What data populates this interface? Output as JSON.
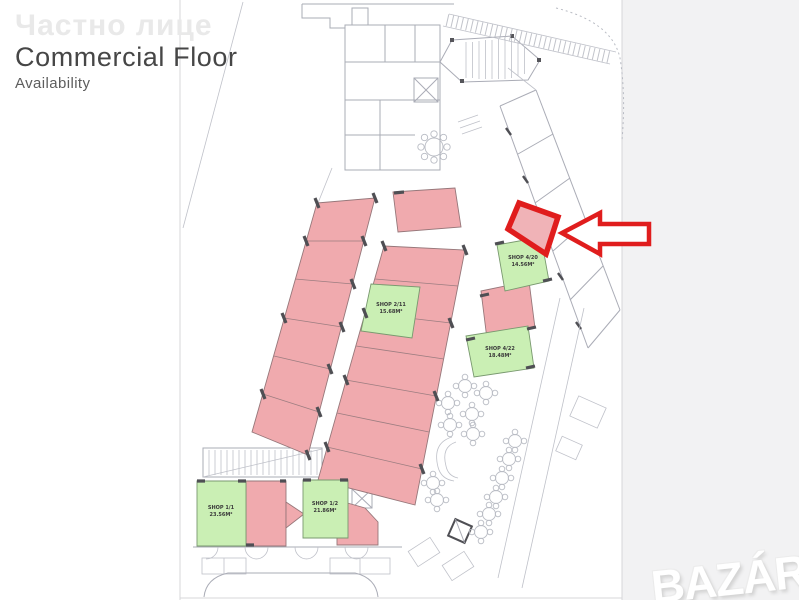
{
  "header": {
    "watermark_text": "Частно лице",
    "title": "Commercial Floor",
    "subtitle": "Availability"
  },
  "plan": {
    "shops": [
      {
        "name": "SHOP 4/20",
        "area": "14.56M²",
        "status": "available"
      },
      {
        "name": "SHOP 2/11",
        "area": "15.68M²",
        "status": "available"
      },
      {
        "name": "SHOP 4/22",
        "area": "18.48M²",
        "status": "available"
      },
      {
        "name": "SHOP 1/1",
        "area": "23.56M²",
        "status": "available"
      },
      {
        "name": "SHOP 1/2",
        "area": "21.86M²",
        "status": "available"
      }
    ],
    "colors": {
      "available_fill": "#caefb4",
      "occupied_fill": "#f0aaae",
      "highlight_red": "#e01d1d",
      "wall_gray": "#aaacb6"
    }
  },
  "watermark_logo": {
    "text": "BAZÁR"
  }
}
